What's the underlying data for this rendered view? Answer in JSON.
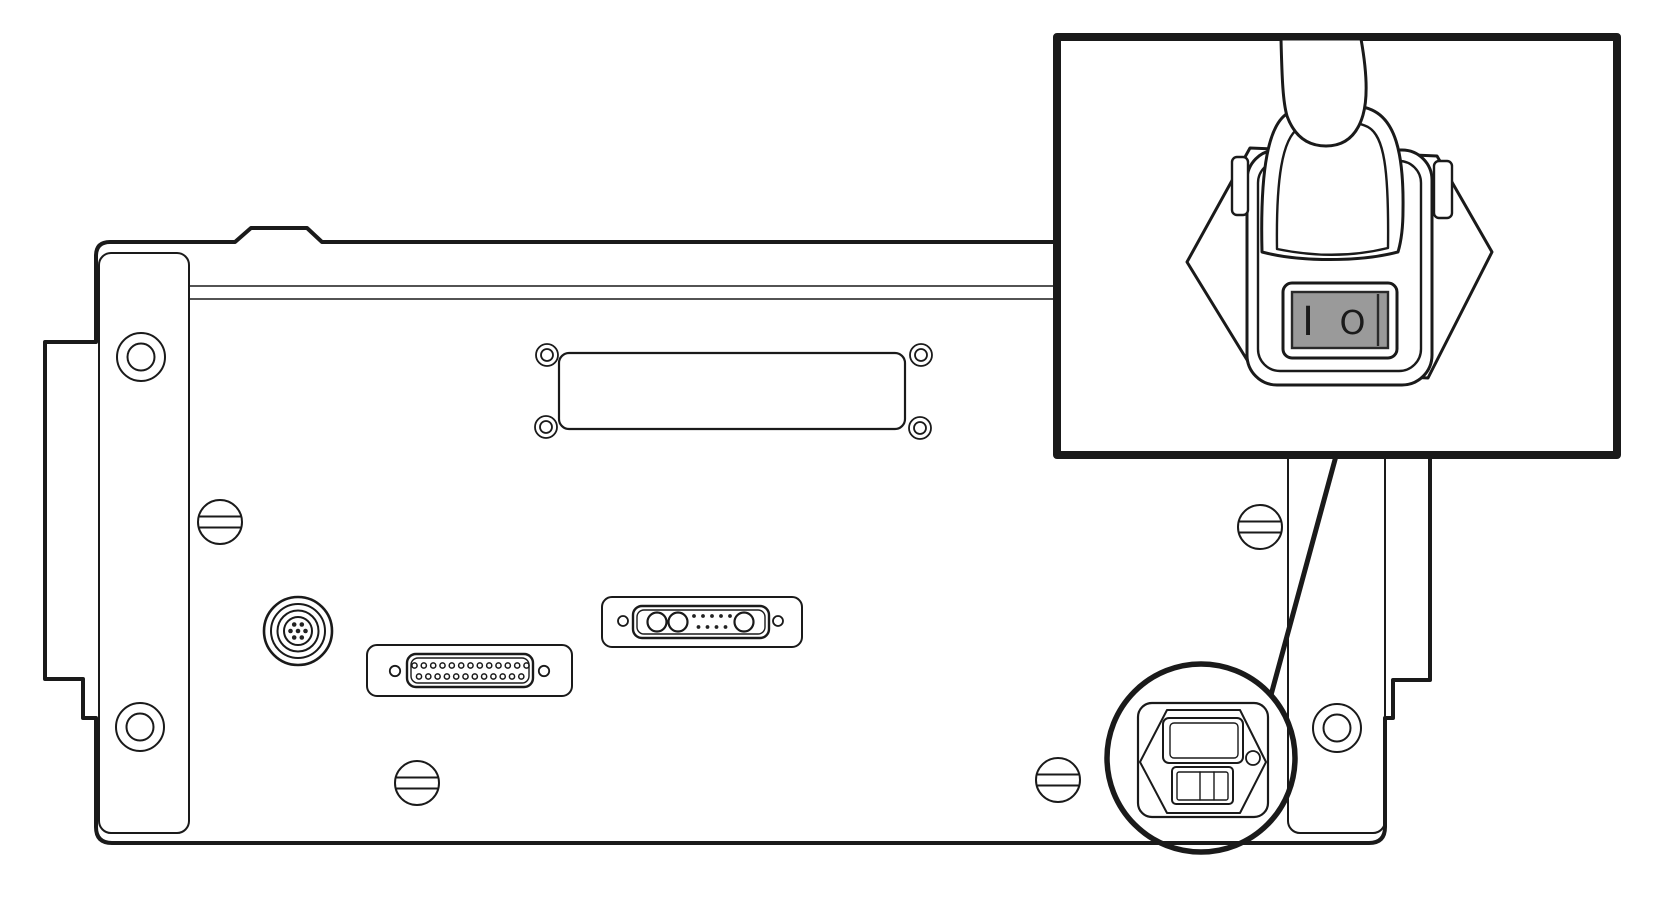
{
  "meta": {
    "description": "Technical line diagram of an instrument rear panel with a magnified inset of the power cord plug rocker switch",
    "background_color": "#ffffff",
    "line_color": "#1a1a1a"
  },
  "inset": {
    "switch": {
      "on_label": "I",
      "off_label": "O",
      "rocker_color": "#9a9a9a",
      "rocker_border_color": "#2a2a2a"
    }
  },
  "callout": {
    "style": "circle-with-leader-line"
  }
}
